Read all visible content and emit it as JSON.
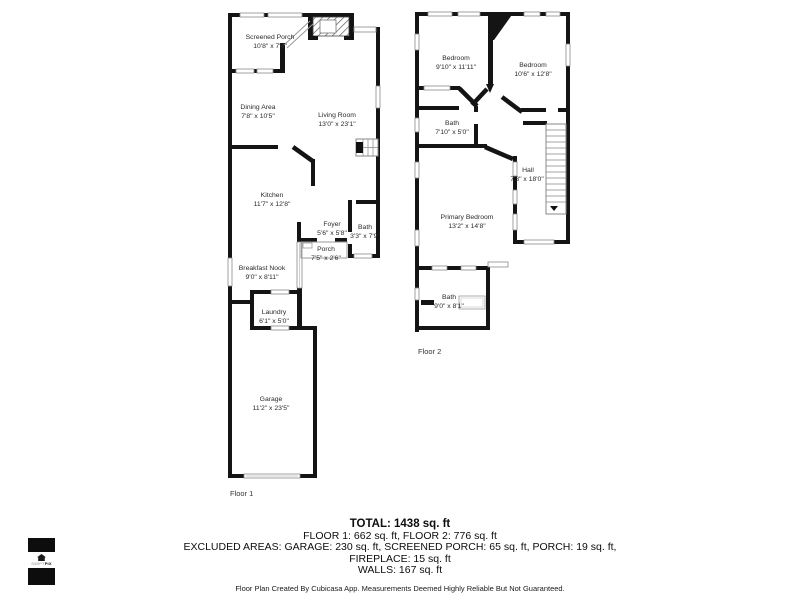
{
  "colors": {
    "wall": "#141414",
    "room_text": "#2a2a2a"
  },
  "floor1": {
    "label": "Floor 1",
    "rooms": [
      {
        "name": "Screened Porch",
        "dims": "10'8\" x 7'4\""
      },
      {
        "name": "Dining Area",
        "dims": "7'8\" x 10'5\""
      },
      {
        "name": "Living Room",
        "dims": "13'0\" x 23'1\""
      },
      {
        "name": "Kitchen",
        "dims": "11'7\" x 12'8\""
      },
      {
        "name": "Foyer",
        "dims": "5'6\" x 5'8\""
      },
      {
        "name": "Bath",
        "dims": "3'3\" x 7'9\""
      },
      {
        "name": "Porch",
        "dims": "7'5\" x 2'6\""
      },
      {
        "name": "Breakfast Nook",
        "dims": "9'0\" x 8'11\""
      },
      {
        "name": "Laundry",
        "dims": "6'1\" x 5'0\""
      },
      {
        "name": "Garage",
        "dims": "11'2\" x 23'5\""
      }
    ]
  },
  "floor2": {
    "label": "Floor 2",
    "rooms": [
      {
        "name": "Bedroom",
        "dims": "9'10\" x 11'11\""
      },
      {
        "name": "Bedroom",
        "dims": "10'6\" x 12'8\""
      },
      {
        "name": "Bath",
        "dims": "7'10\" x 5'0\""
      },
      {
        "name": "Hall",
        "dims": "7'3\" x 18'0\""
      },
      {
        "name": "Primary Bedroom",
        "dims": "13'2\" x 14'8\""
      },
      {
        "name": "Bath",
        "dims": "9'0\" x 8'1\""
      }
    ]
  },
  "summary": {
    "total": "TOTAL: 1438 sq. ft",
    "floors": "FLOOR 1: 662 sq. ft, FLOOR 2: 776 sq. ft",
    "excluded": "EXCLUDED AREAS: GARAGE: 230 sq. ft, SCREENED PORCH: 65 sq. ft, PORCH: 19 sq. ft,",
    "fireplace": "FIREPLACE: 15 sq. ft",
    "walls": "WALLS: 167 sq. ft",
    "disclaimer": "Floor Plan Created By Cubicasa App. Measurements Deemed Highly Reliable But Not Guaranteed."
  },
  "logo": {
    "brand_left": "SWIFT",
    "brand_right": "PIX",
    "icon": "house-icon"
  }
}
